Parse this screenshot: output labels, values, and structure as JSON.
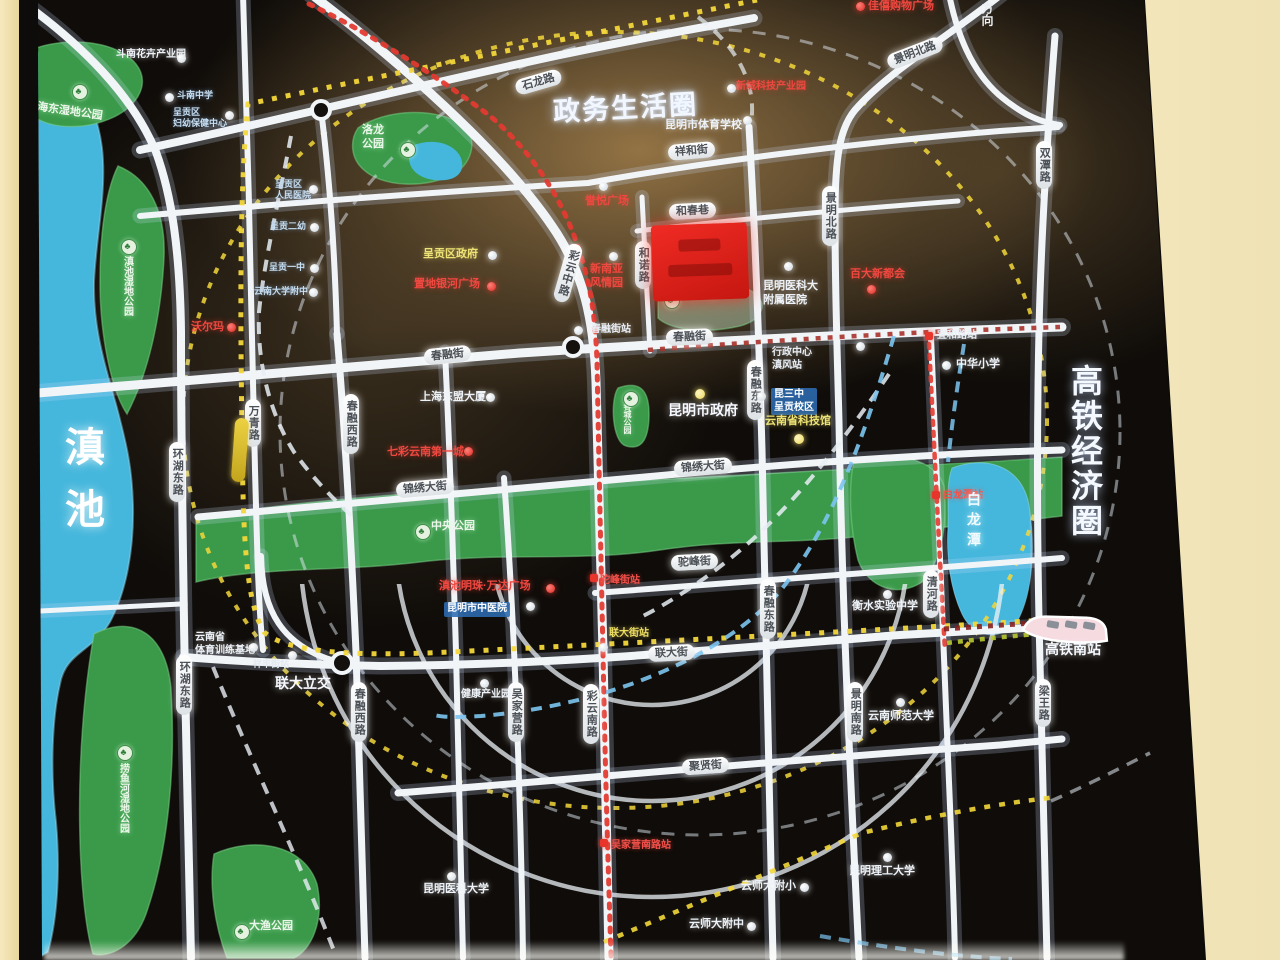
{
  "map": {
    "zones": {
      "gov": {
        "label": "政务生活圈"
      },
      "hsr": {
        "label": "高铁经济圈"
      },
      "direction": {
        "label": "方向"
      }
    },
    "water": {
      "dianchi": "滇池",
      "bailongtan": "白龙潭"
    },
    "accent_colors": {
      "road": "#f2f5f8",
      "park": "#3a9a4a",
      "water": "#45b7dc",
      "metro_yellow": "#f3d73a",
      "metro_red": "#e23a30",
      "metro_blue": "#7cc4f0",
      "project_red": "#e3201d",
      "wall_beige": "#eedca8"
    },
    "park_labels": [
      {
        "label": "海东湿地公园",
        "x": 38,
        "y": 101,
        "rot": 8,
        "tree": {
          "x": 72,
          "y": 84
        }
      },
      {
        "label": "滇池湿地公园",
        "x": 120,
        "y": 256,
        "vertical": true,
        "fs": 10,
        "tree": {
          "x": 121,
          "y": 239
        }
      },
      {
        "label": "捞鱼河湿地公园",
        "x": 116,
        "y": 763,
        "vertical": true,
        "fs": 10,
        "tree": {
          "x": 117,
          "y": 745
        }
      },
      {
        "label": "大渔公园",
        "x": 249,
        "y": 920,
        "tree": {
          "x": 234,
          "y": 924
        }
      },
      {
        "label": "洛龙公园\n",
        "x": 362,
        "y": 124,
        "multiline": "洛龙\n公园",
        "tree": {
          "x": 400,
          "y": 142
        }
      },
      {
        "label": "中央公园",
        "x": 431,
        "y": 520,
        "tree": {
          "x": 415,
          "y": 524
        }
      },
      {
        "label": "春城公园",
        "x": 622,
        "y": 402,
        "vertical": true,
        "fs": 8,
        "tree": {
          "x": 623,
          "y": 391
        }
      },
      {
        "label": "春融公园",
        "x": 678,
        "y": 290,
        "cls": "pale",
        "fs": 10,
        "tree": {
          "x": 664,
          "y": 293
        }
      }
    ],
    "road_pills": [
      {
        "label": "石龙路",
        "x": 515,
        "y": 74,
        "rot": -16
      },
      {
        "label": "祥和街",
        "x": 668,
        "y": 143,
        "rot": -5
      },
      {
        "label": "和春巷",
        "x": 669,
        "y": 203,
        "rot": -3
      },
      {
        "label": "春融街",
        "x": 666,
        "y": 329,
        "rot": -2
      },
      {
        "label": "春融街",
        "x": 424,
        "y": 347,
        "rot": -6
      },
      {
        "label": "锦绣大街",
        "x": 674,
        "y": 459,
        "rot": -4
      },
      {
        "label": "锦绣大街",
        "x": 396,
        "y": 480,
        "rot": -5
      },
      {
        "label": "驼峰街",
        "x": 671,
        "y": 554,
        "rot": -3
      },
      {
        "label": "联大街",
        "x": 648,
        "y": 645,
        "rot": -3
      },
      {
        "label": "聚贤街",
        "x": 682,
        "y": 758,
        "rot": -4
      },
      {
        "label": "景明北路",
        "x": 886,
        "y": 45,
        "rot": -21
      },
      {
        "label": "彩云中路",
        "x": 560,
        "y": 243,
        "rot": 16,
        "vertical": true
      },
      {
        "label": "彩云南路",
        "x": 583,
        "y": 684,
        "vertical": true
      },
      {
        "label": "万青路",
        "x": 245,
        "y": 399,
        "vertical": true
      },
      {
        "label": "吴家营路",
        "x": 508,
        "y": 682,
        "vertical": true
      },
      {
        "label": "和诺路",
        "x": 635,
        "y": 241,
        "vertical": true
      },
      {
        "label": "春融西路",
        "x": 343,
        "y": 394,
        "vertical": true
      },
      {
        "label": "春融西路",
        "x": 351,
        "y": 682,
        "vertical": true
      },
      {
        "label": "环湖东路",
        "x": 169,
        "y": 442,
        "vertical": true
      },
      {
        "label": "环湖东路",
        "x": 176,
        "y": 655,
        "vertical": true
      },
      {
        "label": "春融东路",
        "x": 747,
        "y": 360,
        "vertical": true
      },
      {
        "label": "春融东路",
        "x": 760,
        "y": 579,
        "vertical": true
      },
      {
        "label": "景明北路",
        "x": 822,
        "y": 186,
        "vertical": true
      },
      {
        "label": "景明南路",
        "x": 847,
        "y": 682,
        "vertical": true
      },
      {
        "label": "清河路",
        "x": 923,
        "y": 570,
        "vertical": true
      },
      {
        "label": "双潭路",
        "x": 1036,
        "y": 141,
        "vertical": true
      },
      {
        "label": "梁王路",
        "x": 1035,
        "y": 679,
        "vertical": true
      }
    ],
    "stations": [
      {
        "label": "春融街站",
        "x": 591,
        "y": 324,
        "cls": "st-white",
        "dot": {
          "x": 574,
          "y": 326,
          "t": "white"
        }
      },
      {
        "label": "行政中心\n滇风站",
        "x": 772,
        "y": 347,
        "cls": "st-white",
        "dot": {
          "x": 856,
          "y": 342,
          "t": "white"
        }
      },
      {
        "label": "宜和路站",
        "x": 937,
        "y": 330,
        "cls": "st-white",
        "dot": {
          "x": 925,
          "y": 332,
          "t": "redsq"
        }
      },
      {
        "label": "驼峰街站",
        "x": 600,
        "y": 575,
        "cls": "st-red",
        "dot": {
          "x": 590,
          "y": 574,
          "t": "redsq"
        }
      },
      {
        "label": "联大街站",
        "x": 609,
        "y": 628,
        "cls": "st-yellow",
        "dot": {
          "x": 599,
          "y": 643,
          "t": "white"
        }
      },
      {
        "label": "祥丰街站",
        "x": 253,
        "y": 659,
        "cls": "st-white-sm",
        "dot": {
          "x": 288,
          "y": 651,
          "t": "white"
        }
      },
      {
        "label": "吴家营南路站",
        "x": 611,
        "y": 840,
        "cls": "st-red",
        "dot": {
          "x": 600,
          "y": 839,
          "t": "redsq"
        }
      },
      {
        "label": "白龙潭站",
        "x": 943,
        "y": 490,
        "cls": "st-red",
        "dot": {
          "x": 932,
          "y": 491,
          "t": "redsq"
        }
      }
    ],
    "pois": [
      {
        "label": "斗南花卉产业园",
        "x": 116,
        "y": 49,
        "cls": "w",
        "fs": 10,
        "dot": {
          "x": 177,
          "y": 54,
          "t": "white"
        }
      },
      {
        "label": "斗南中学",
        "x": 177,
        "y": 90,
        "cls": "lb",
        "dot": {
          "x": 165,
          "y": 93,
          "t": "white"
        }
      },
      {
        "label": "呈贡区\n妇幼保健中心",
        "x": 173,
        "y": 107,
        "cls": "lb",
        "dot": {
          "x": 225,
          "y": 111,
          "t": "white"
        }
      },
      {
        "label": "呈贡区\n人民医院",
        "x": 275,
        "y": 179,
        "cls": "lb",
        "dot": {
          "x": 309,
          "y": 185,
          "t": "white"
        }
      },
      {
        "label": "呈贡二幼",
        "x": 270,
        "y": 221,
        "cls": "lb",
        "dot": {
          "x": 310,
          "y": 223,
          "t": "white"
        }
      },
      {
        "label": "呈贡一中",
        "x": 269,
        "y": 262,
        "cls": "lb",
        "dot": {
          "x": 310,
          "y": 264,
          "t": "white"
        }
      },
      {
        "label": "云南大学附中",
        "x": 254,
        "y": 286,
        "cls": "lb",
        "dot": {
          "x": 309,
          "y": 288,
          "t": "white"
        }
      },
      {
        "label": "沃尔玛",
        "x": 191,
        "y": 321,
        "cls": "r",
        "dot": {
          "x": 227,
          "y": 323,
          "t": "red"
        }
      },
      {
        "label": "呈贡区政府",
        "x": 423,
        "y": 248,
        "cls": "y",
        "dot": {
          "x": 488,
          "y": 251,
          "t": "white"
        }
      },
      {
        "label": "置地银河广场",
        "x": 414,
        "y": 278,
        "cls": "r",
        "dot": {
          "x": 487,
          "y": 282,
          "t": "red"
        }
      },
      {
        "label": "誉悦广场",
        "x": 585,
        "y": 195,
        "cls": "r",
        "dot": {
          "x": 599,
          "y": 182,
          "t": "white"
        }
      },
      {
        "label": "新南亚\n风情园",
        "x": 590,
        "y": 263,
        "cls": "r",
        "dot": {
          "x": 609,
          "y": 252,
          "t": "white"
        }
      },
      {
        "label": "新城科技产业园",
        "x": 736,
        "y": 81,
        "cls": "r",
        "fs": 10,
        "dot": {
          "x": 727,
          "y": 84,
          "t": "white"
        }
      },
      {
        "label": "佳僖购物广场",
        "x": 868,
        "y": 0,
        "cls": "r",
        "dot": {
          "x": 856,
          "y": 2,
          "t": "red"
        }
      },
      {
        "label": "昆明市体育学校",
        "x": 665,
        "y": 119,
        "cls": "w",
        "dot": {
          "x": 743,
          "y": 116,
          "t": "white"
        }
      },
      {
        "label": "上海东盟大厦",
        "x": 420,
        "y": 391,
        "cls": "w",
        "dot": {
          "x": 486,
          "y": 393,
          "t": "white"
        }
      },
      {
        "label": "七彩云南第一城",
        "x": 387,
        "y": 446,
        "cls": "r",
        "dot": {
          "x": 464,
          "y": 447,
          "t": "red"
        }
      },
      {
        "label": "昆明市政府",
        "x": 668,
        "y": 402,
        "cls": "wb",
        "dot": {
          "x": 695,
          "y": 389,
          "t": "yellow"
        }
      },
      {
        "label": "昆明医科大\n附属医院",
        "x": 763,
        "y": 280,
        "cls": "w",
        "dot": {
          "x": 784,
          "y": 262,
          "t": "white"
        }
      },
      {
        "label": "百大新都会",
        "x": 850,
        "y": 268,
        "cls": "r",
        "dot": {
          "x": 867,
          "y": 285,
          "t": "red"
        }
      },
      {
        "label": "昆三中\n呈贡校区",
        "x": 771,
        "y": 388,
        "cls": "bb",
        "dot": {
          "x": 757,
          "y": 392,
          "t": "white"
        }
      },
      {
        "label": "云南省科技馆",
        "x": 765,
        "y": 415,
        "cls": "y",
        "dot": {
          "x": 794,
          "y": 434,
          "t": "yellow"
        }
      },
      {
        "label": "中华小学",
        "x": 956,
        "y": 358,
        "cls": "w",
        "dot": {
          "x": 942,
          "y": 361,
          "t": "white"
        }
      },
      {
        "label": "衡水实验中学",
        "x": 852,
        "y": 600,
        "cls": "w",
        "dot": {
          "x": 883,
          "y": 590,
          "t": "white"
        }
      },
      {
        "label": "滇池明珠·万达广场",
        "x": 439,
        "y": 580,
        "cls": "r",
        "dot": {
          "x": 546,
          "y": 584,
          "t": "red"
        }
      },
      {
        "label": "昆明市中医院",
        "x": 444,
        "y": 602,
        "cls": "bb",
        "dot": {
          "x": 526,
          "y": 602,
          "t": "white"
        }
      },
      {
        "label": "云南省\n体育训练基地",
        "x": 195,
        "y": 632,
        "cls": "w",
        "fs": 10,
        "dot": {
          "x": 249,
          "y": 643,
          "t": "white"
        }
      },
      {
        "label": "联大立交",
        "x": 275,
        "y": 675,
        "cls": "wb"
      },
      {
        "label": "健康产业园",
        "x": 461,
        "y": 689,
        "cls": "w",
        "fs": 10,
        "dot": {
          "x": 480,
          "y": 679,
          "t": "white"
        }
      },
      {
        "label": "昆明医科大学",
        "x": 423,
        "y": 883,
        "cls": "w",
        "dot": {
          "x": 447,
          "y": 872,
          "t": "white"
        }
      },
      {
        "label": "云师大附小",
        "x": 741,
        "y": 880,
        "cls": "w",
        "dot": {
          "x": 800,
          "y": 883,
          "t": "white"
        }
      },
      {
        "label": "云师大附中",
        "x": 689,
        "y": 918,
        "cls": "w",
        "dot": {
          "x": 747,
          "y": 922,
          "t": "white"
        }
      },
      {
        "label": "云南师范大学",
        "x": 868,
        "y": 710,
        "cls": "w",
        "dot": {
          "x": 896,
          "y": 698,
          "t": "white"
        }
      },
      {
        "label": "昆明理工大学",
        "x": 849,
        "y": 865,
        "cls": "w",
        "dot": {
          "x": 883,
          "y": 853,
          "t": "white"
        }
      },
      {
        "label": "高铁南站",
        "x": 1045,
        "y": 641,
        "cls": "wb"
      }
    ]
  }
}
